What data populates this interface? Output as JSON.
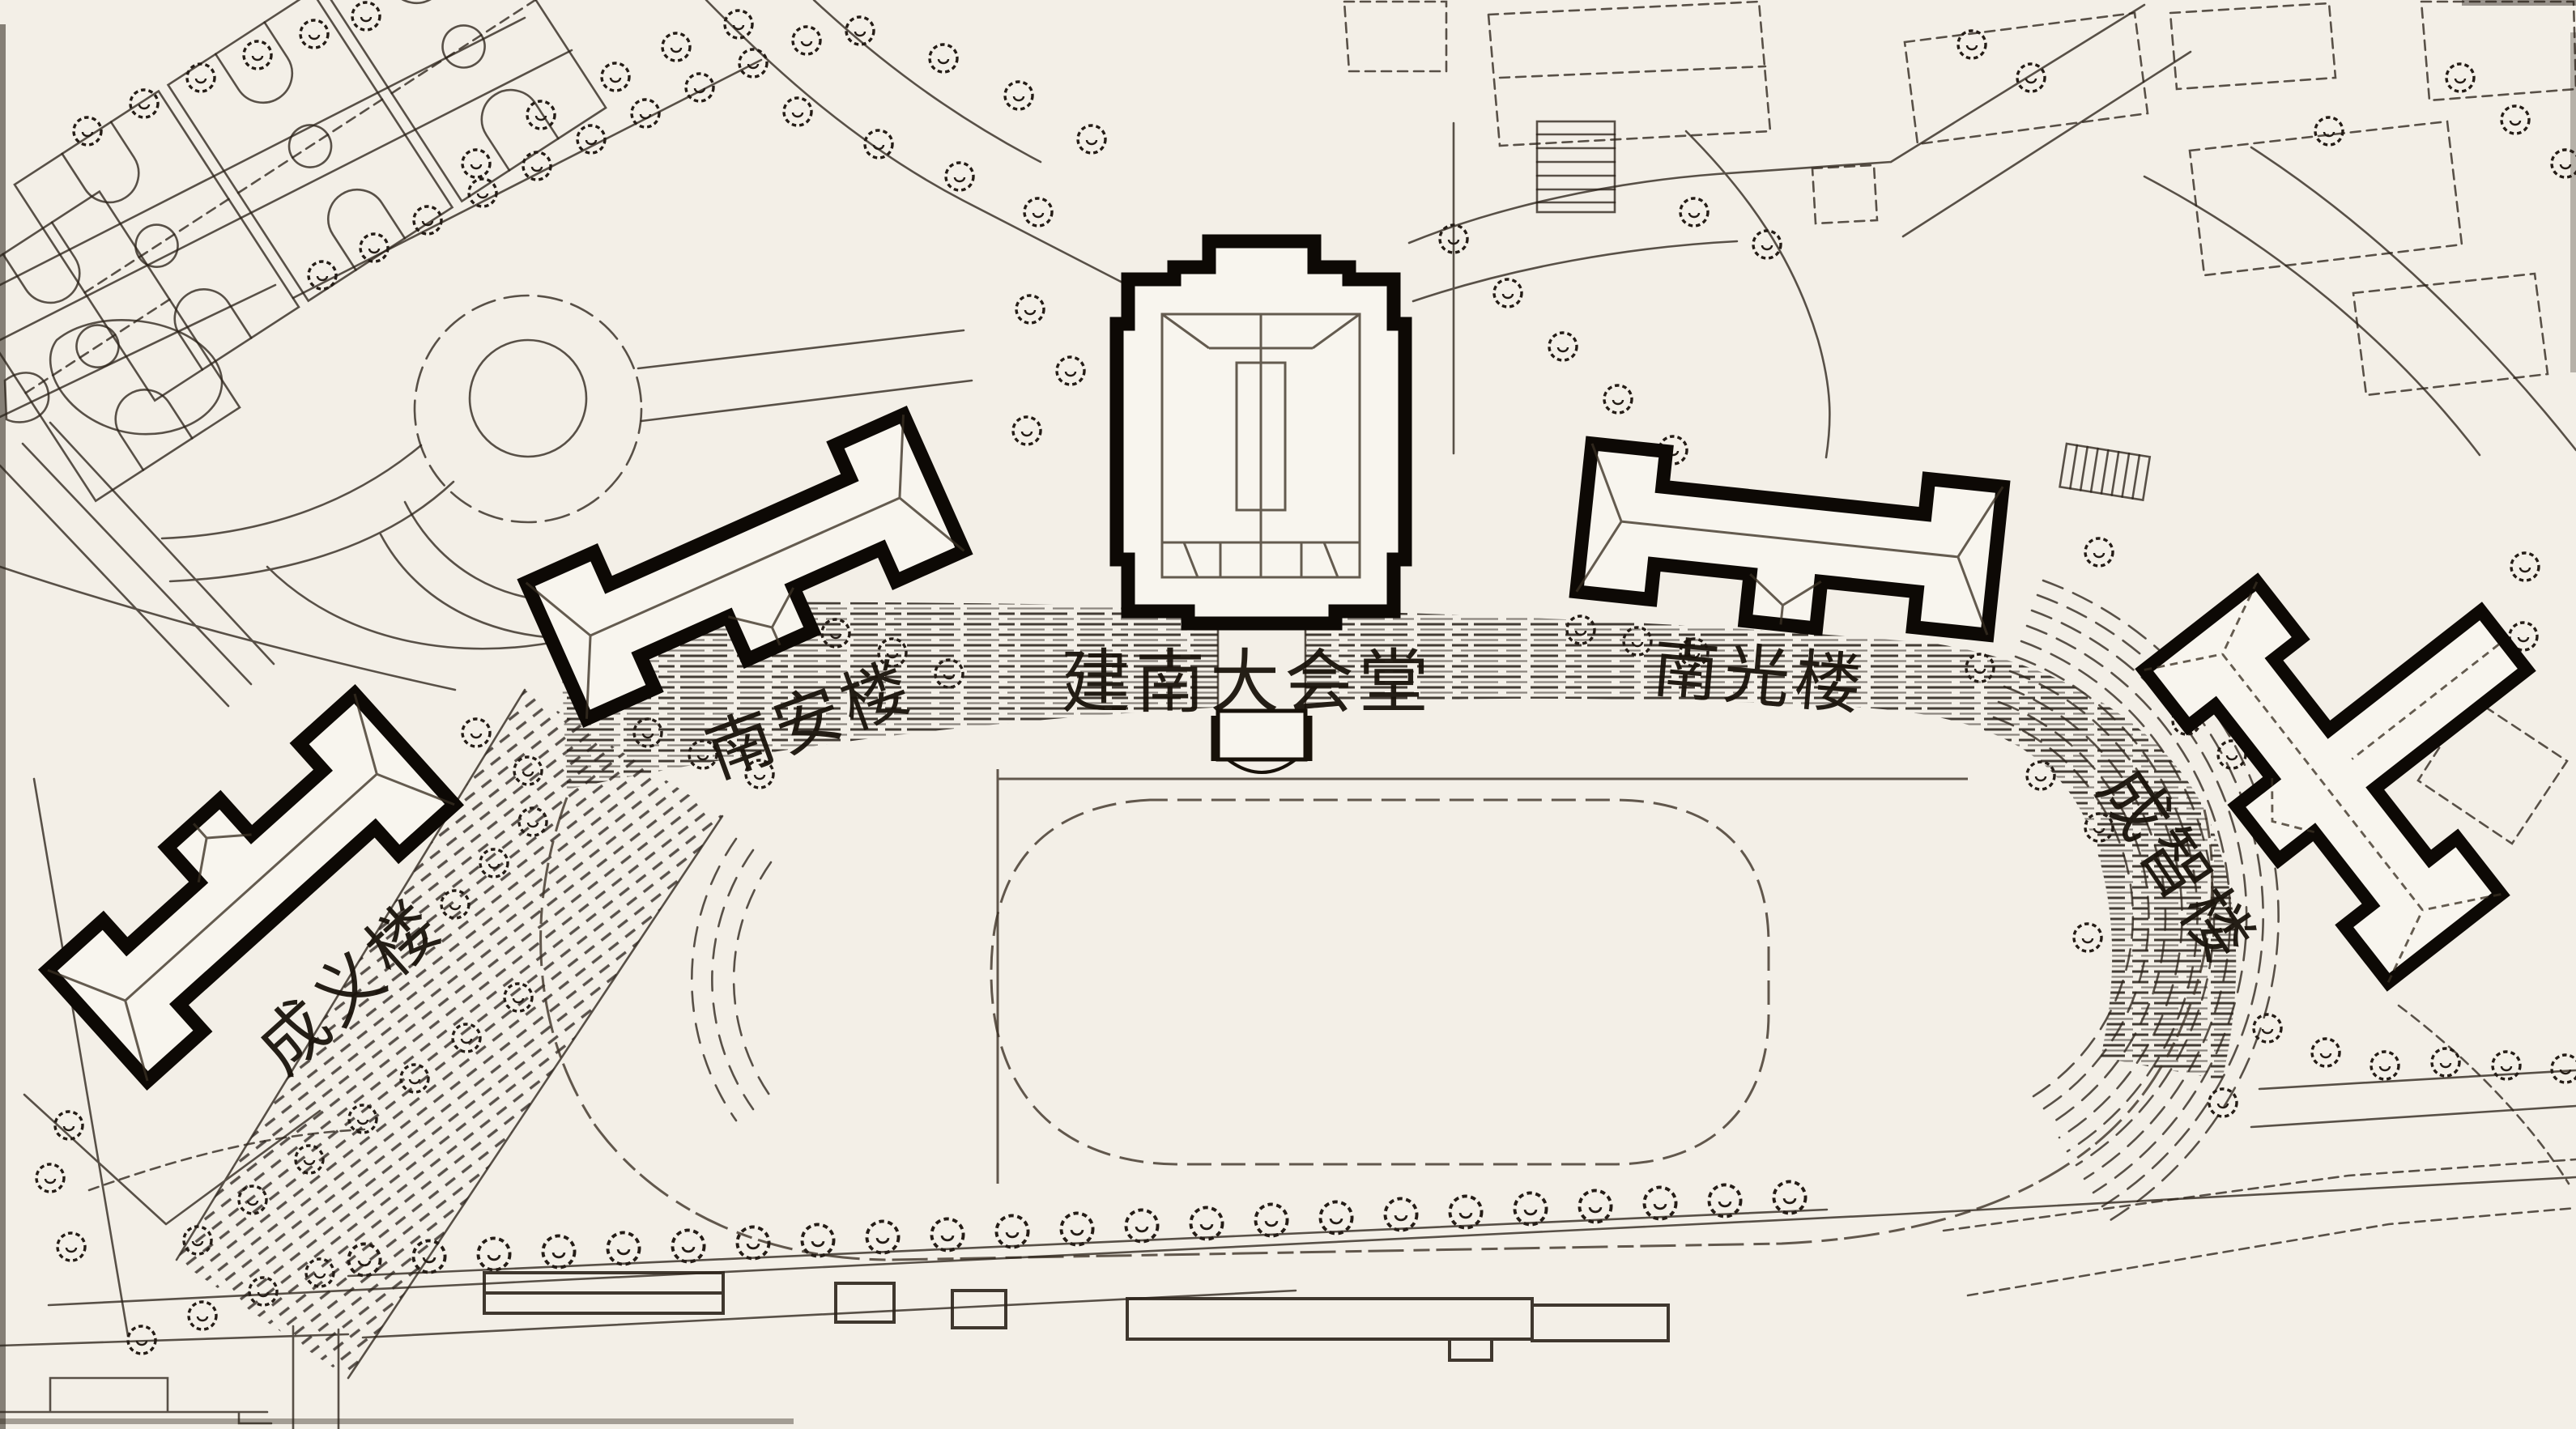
{
  "site_plan": {
    "labels": {
      "auditorium": "建南大会堂",
      "nanan": "南安楼",
      "nanguang": "南光楼",
      "chengyi": "成义楼",
      "chengzhi": "成智楼"
    },
    "colors": {
      "paper": "#f3efe7",
      "ink": "#2b2219",
      "building_outline": "#0d0905",
      "building_fill": "#f8f5ee",
      "label_ink": "#181109"
    }
  }
}
